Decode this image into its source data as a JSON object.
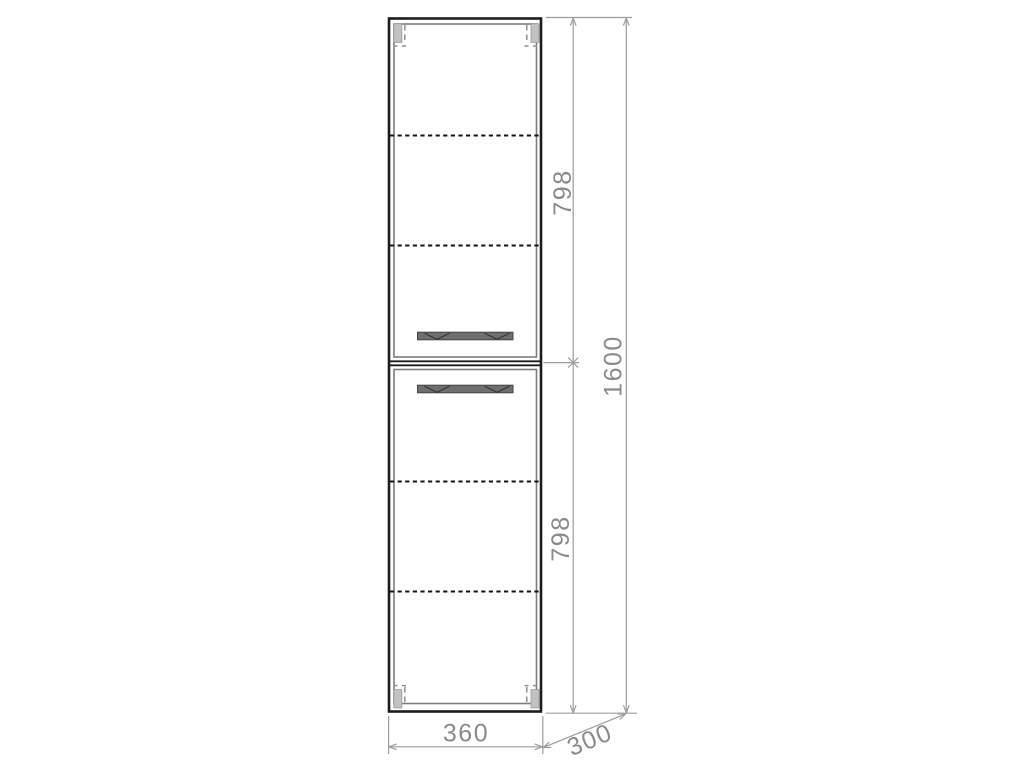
{
  "drawing": {
    "kind": "cabinet-front-elevation",
    "labels": {
      "upper_section_height": "798",
      "lower_section_height": "798",
      "total_height": "1600",
      "width": "360",
      "depth": "300"
    },
    "colors": {
      "outline": "#1c1c1c",
      "door_edge": "#7d7d7d",
      "handle_fill": "#6f6f6f",
      "hinge_fill": "#c2c2c2",
      "dimension_line": "#9d9d9d",
      "dimension_text": "#8a8a8a",
      "background": "#ffffff"
    }
  }
}
